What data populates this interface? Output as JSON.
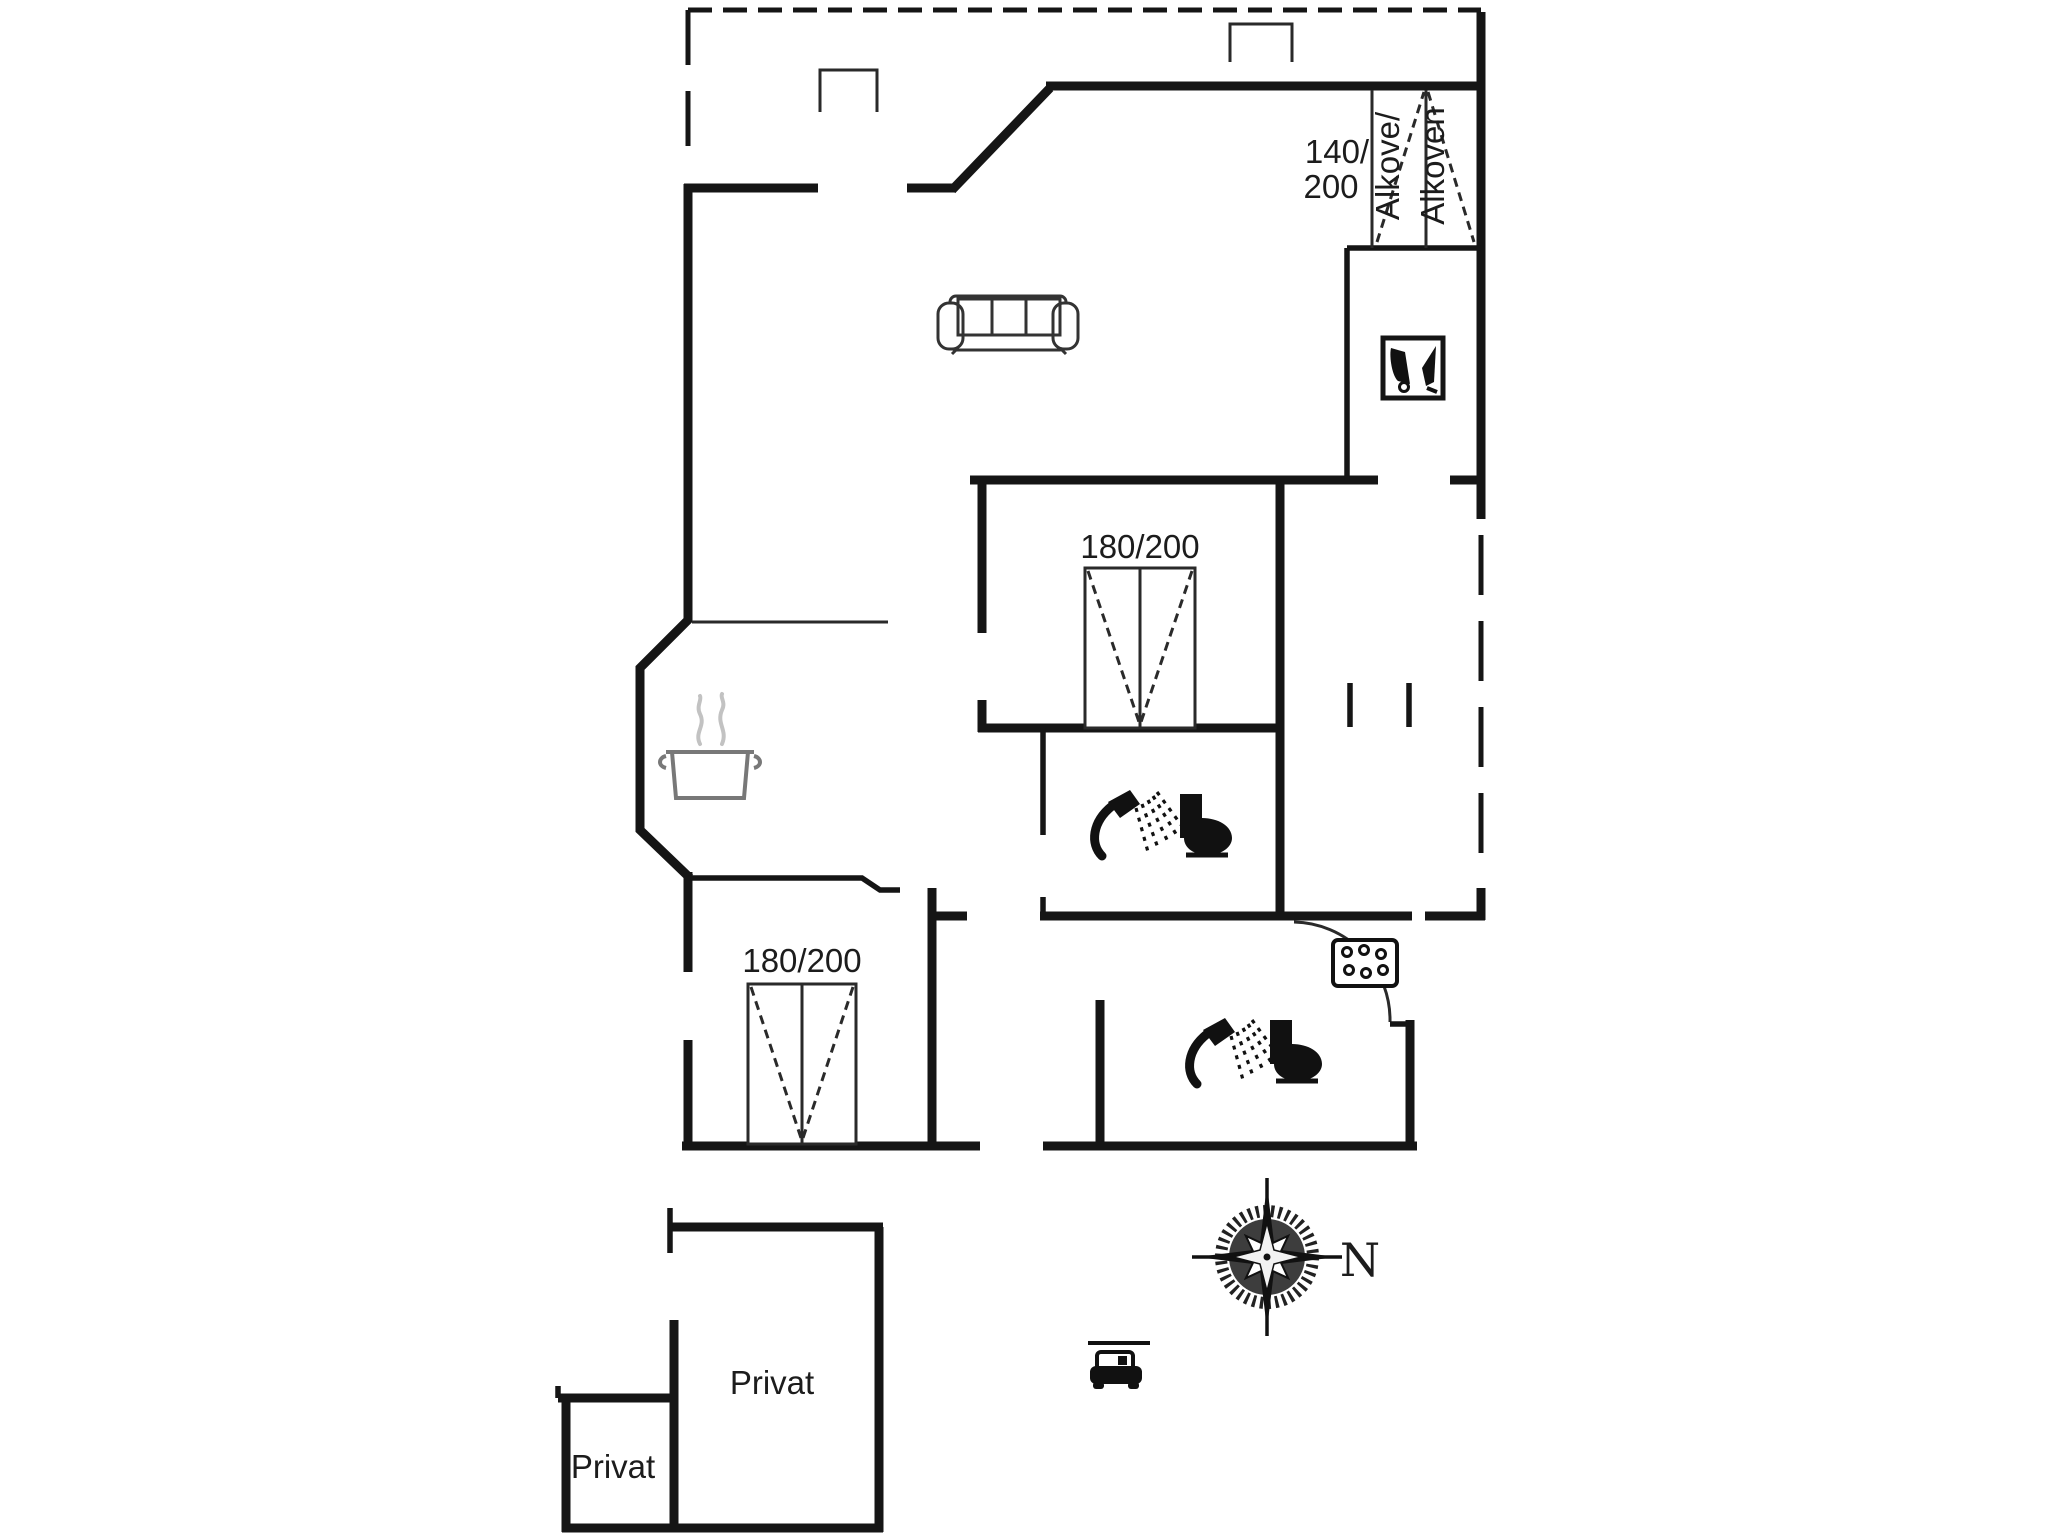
{
  "floor_plan": {
    "background_color": "#ffffff",
    "wall_color": "#151515",
    "symbol_gray_color": "#787878",
    "alcove": {
      "dimension_line1": "140/",
      "dimension_line2": "200",
      "label_left": "Alkove/",
      "label_right": "Alkoven"
    },
    "middle_bedroom": {
      "bed_size": "180/200"
    },
    "lower_bedroom": {
      "bed_size": "180/200"
    },
    "annex": {
      "room_large_label": "Privat",
      "room_small_label": "Privat"
    },
    "compass": {
      "north_label": "N"
    },
    "icons": [
      "sofa-icon",
      "cooking-pot-icon",
      "chair-icon",
      "shower-icon",
      "toilet-icon",
      "hob-icon",
      "compass-rose-icon",
      "car-icon"
    ]
  }
}
